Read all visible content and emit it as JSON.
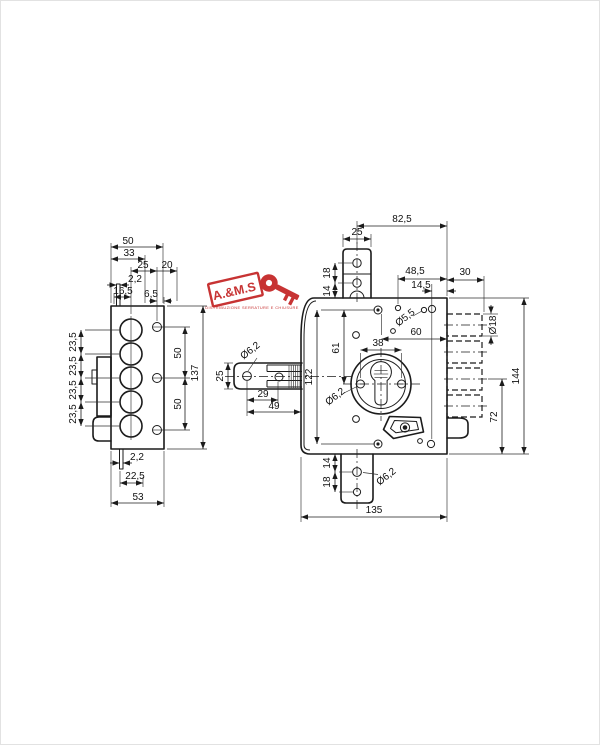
{
  "logo": {
    "brand": "A.&M.S",
    "tagline": "DISTRIBUZIONE SERRATURE E CHIUSURE",
    "color": "#c32222"
  },
  "side_view": {
    "dims": {
      "w50": "50",
      "w33": "33",
      "w25": "25",
      "w20": "20",
      "pin_top": "2,2",
      "w16_5": "16,5",
      "w6_5": "6,5",
      "p1": "23,5",
      "p2": "23,5",
      "p3": "23,5",
      "p4": "23,5",
      "s1": "50",
      "s2": "50",
      "h137": "137",
      "pin_bot": "2,2",
      "w22_5": "22,5",
      "w53": "53"
    }
  },
  "bolt_view": {
    "dims": {
      "h25": "25",
      "dia6_2": "Ø6,2",
      "w29": "29",
      "w49": "49"
    }
  },
  "front_view": {
    "dims": {
      "w82_5": "82,5",
      "tab_w25": "25",
      "t18": "18",
      "t14": "14",
      "w48_5": "48,5",
      "w14_5": "14,5",
      "w30": "30",
      "dia5_5": "Ø5,5",
      "w60": "60",
      "w38": "38",
      "h61": "61",
      "h122": "122",
      "dia6_2": "Ø6,2",
      "dia18": "Ø18",
      "h144": "144",
      "h72": "72",
      "b14": "14",
      "b18": "18",
      "dia6_2b": "Ø6,2",
      "w135": "135"
    }
  }
}
